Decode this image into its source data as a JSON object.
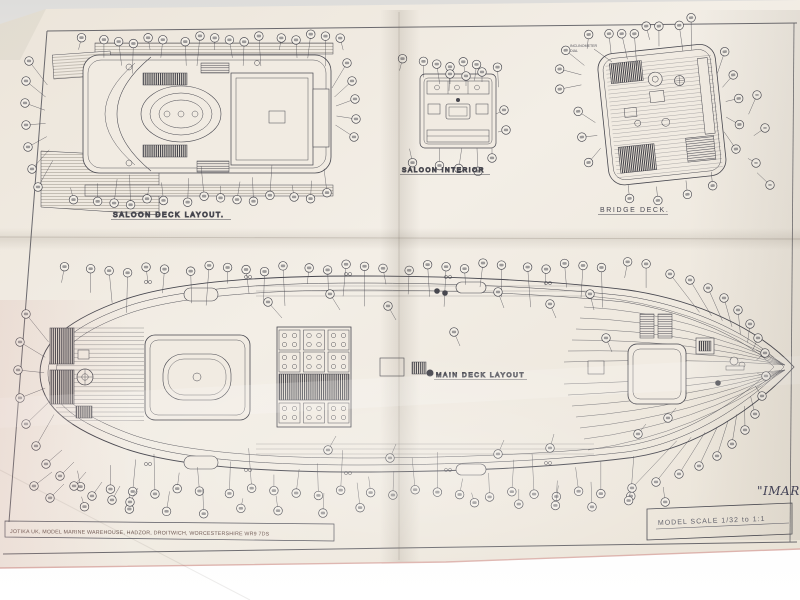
{
  "photo": {
    "backdrop_color": "#e4e3df",
    "paper_color": "#f0eae1",
    "ink_color": "#47474f",
    "paper_edge_pink": "#d8a8a2",
    "footer_ink": "#6d5751"
  },
  "titles": {
    "saloon_deck": "SALOON DECK LAYOUT.",
    "saloon_interior": "SALOON INTERIOR",
    "bridge_deck": "BRIDGE DECK.",
    "main_deck": "MAIN DECK LAYOUT"
  },
  "notes": {
    "inclinometer_line1": "INCLINOMETER",
    "inclinometer_line2": "DIAL"
  },
  "title_block": {
    "scale_label": "MODEL SCALE  1/32 to 1:1"
  },
  "footer": {
    "maker_address": "JOTIKA UK, MODEL MARINE WAREHOUSE, HADZOR, DROITWICH, WORCESTERSHIRE  WR9 7DS"
  },
  "ship_name_partial": "\"IMAR"
}
